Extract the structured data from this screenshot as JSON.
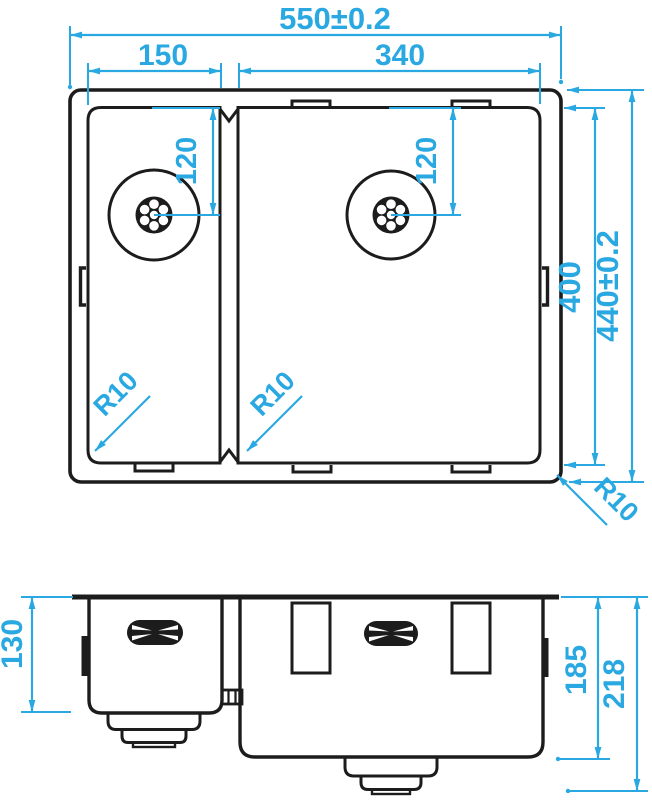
{
  "drawing": {
    "type": "sink-technical-drawing",
    "colors": {
      "dimension": "#29a8e1",
      "outline": "#1c1c1c",
      "background": "#ffffff"
    },
    "dimensions": {
      "overall_width": "550±0.2",
      "left_bowl_width": "150",
      "right_bowl_width": "340",
      "drain_offset_left": "120",
      "drain_offset_right": "120",
      "bowl_depth": "400",
      "overall_depth": "440±0.2",
      "radius_left_bowl": "R10",
      "radius_right_bowl": "R10",
      "radius_outer": "R10",
      "left_bowl_height": "130",
      "right_bowl_height": "185",
      "overall_height": "218"
    }
  }
}
